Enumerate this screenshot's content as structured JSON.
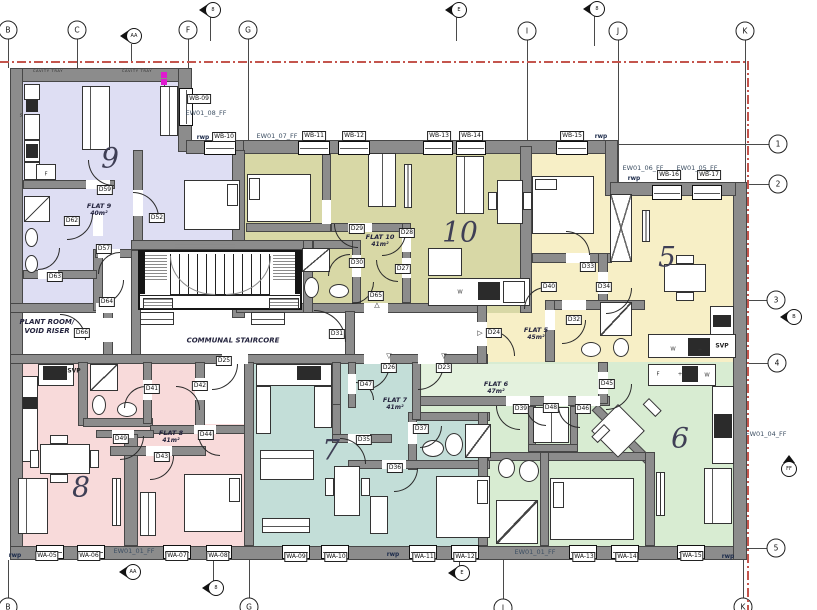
{
  "colors": {
    "wall": "#8c8c8c",
    "flat9": "#dedef3",
    "flat10": "#d8d8a6",
    "flat5": "#f7efc6",
    "flat8": "#f8dada",
    "flat7": "#c3ded8",
    "flat6": "#d8ecd2",
    "flat6_lobby": "#e4f2de",
    "boundary_line": "#c4554d",
    "marker_magenta": "#e019d0"
  },
  "flats": [
    {
      "l1": "FLAT 9",
      "l2": "40m²",
      "x": 99,
      "y": 210
    },
    {
      "l1": "FLAT 10",
      "l2": "41m²",
      "x": 380,
      "y": 241
    },
    {
      "l1": "FLAT 5",
      "l2": "45m²",
      "x": 536,
      "y": 334
    },
    {
      "l1": "FLAT 8",
      "l2": "41m²",
      "x": 171,
      "y": 437
    },
    {
      "l1": "FLAT 7",
      "l2": "41m²",
      "x": 395,
      "y": 404
    },
    {
      "l1": "FLAT 6",
      "l2": "47m²",
      "x": 496,
      "y": 388
    }
  ],
  "big_numbers": [
    {
      "t": "9",
      "x": 110,
      "y": 158
    },
    {
      "t": "10",
      "x": 460,
      "y": 232
    },
    {
      "t": "5",
      "x": 667,
      "y": 257
    },
    {
      "t": "8",
      "x": 81,
      "y": 487
    },
    {
      "t": "7",
      "x": 331,
      "y": 450
    },
    {
      "t": "6",
      "x": 680,
      "y": 438
    }
  ],
  "room_labels": [
    {
      "l1": "PLANT ROOM/",
      "l2": "VOID RISER",
      "x": 47,
      "y": 327
    },
    {
      "l1": "COMMUNAL STAIRCORE",
      "l2": "",
      "x": 233,
      "y": 341
    }
  ],
  "door_tags": [
    {
      "t": "D59",
      "x": 105,
      "y": 190
    },
    {
      "t": "D62",
      "x": 72,
      "y": 221
    },
    {
      "t": "D52",
      "x": 157,
      "y": 218
    },
    {
      "t": "D57",
      "x": 104,
      "y": 249
    },
    {
      "t": "D63",
      "x": 55,
      "y": 277
    },
    {
      "t": "D64",
      "x": 107,
      "y": 302
    },
    {
      "t": "D66",
      "x": 82,
      "y": 333
    },
    {
      "t": "D31",
      "x": 337,
      "y": 334
    },
    {
      "t": "D25",
      "x": 224,
      "y": 361
    },
    {
      "t": "D29",
      "x": 357,
      "y": 229
    },
    {
      "t": "D28",
      "x": 407,
      "y": 233
    },
    {
      "t": "D30",
      "x": 357,
      "y": 263
    },
    {
      "t": "D27",
      "x": 403,
      "y": 269
    },
    {
      "t": "D65",
      "x": 376,
      "y": 296
    },
    {
      "t": "D24",
      "x": 494,
      "y": 333
    },
    {
      "t": "D33",
      "x": 588,
      "y": 267
    },
    {
      "t": "D40",
      "x": 549,
      "y": 287
    },
    {
      "t": "D34",
      "x": 604,
      "y": 287
    },
    {
      "t": "D32",
      "x": 574,
      "y": 320
    },
    {
      "t": "D41",
      "x": 152,
      "y": 389
    },
    {
      "t": "D42",
      "x": 200,
      "y": 386
    },
    {
      "t": "D44",
      "x": 206,
      "y": 435
    },
    {
      "t": "D49",
      "x": 121,
      "y": 439
    },
    {
      "t": "D43",
      "x": 162,
      "y": 457
    },
    {
      "t": "D26",
      "x": 389,
      "y": 368
    },
    {
      "t": "D23",
      "x": 444,
      "y": 368
    },
    {
      "t": "D47",
      "x": 366,
      "y": 385
    },
    {
      "t": "D35",
      "x": 364,
      "y": 440
    },
    {
      "t": "D36",
      "x": 395,
      "y": 468
    },
    {
      "t": "D37",
      "x": 421,
      "y": 429
    },
    {
      "t": "D45",
      "x": 607,
      "y": 384
    },
    {
      "t": "D39",
      "x": 521,
      "y": 409
    },
    {
      "t": "D48",
      "x": 551,
      "y": 408
    },
    {
      "t": "D46",
      "x": 583,
      "y": 409
    }
  ],
  "window_tags": [
    {
      "t": "WB-09",
      "x": 199,
      "y": 99
    },
    {
      "t": "WB-10",
      "x": 224,
      "y": 137
    },
    {
      "t": "WB-11",
      "x": 314,
      "y": 136
    },
    {
      "t": "WB-12",
      "x": 354,
      "y": 136
    },
    {
      "t": "WB-13",
      "x": 439,
      "y": 136
    },
    {
      "t": "WB-14",
      "x": 471,
      "y": 136
    },
    {
      "t": "WB-15",
      "x": 572,
      "y": 136
    },
    {
      "t": "WB-16",
      "x": 669,
      "y": 175
    },
    {
      "t": "WB-17",
      "x": 709,
      "y": 175
    },
    {
      "t": "WA-05",
      "x": 47,
      "y": 556
    },
    {
      "t": "WA-06",
      "x": 89,
      "y": 556
    },
    {
      "t": "WA-07",
      "x": 177,
      "y": 556
    },
    {
      "t": "WA-08",
      "x": 218,
      "y": 556
    },
    {
      "t": "WA-09",
      "x": 296,
      "y": 557
    },
    {
      "t": "WA-10",
      "x": 336,
      "y": 557
    },
    {
      "t": "WA-11",
      "x": 424,
      "y": 557
    },
    {
      "t": "WA-12",
      "x": 465,
      "y": 557
    },
    {
      "t": "WA-13",
      "x": 584,
      "y": 557
    },
    {
      "t": "WA-14",
      "x": 627,
      "y": 557
    },
    {
      "t": "WA-15",
      "x": 692,
      "y": 556
    }
  ],
  "texts": [
    {
      "t": "EW01_08_FF",
      "x": 206,
      "y": 113,
      "cls": "ew"
    },
    {
      "t": "EW01_07_FF",
      "x": 277,
      "y": 136,
      "cls": "ew"
    },
    {
      "t": "EW01_06_FF",
      "x": 643,
      "y": 168,
      "cls": "ew"
    },
    {
      "t": "EW01_05_FF",
      "x": 697,
      "y": 168,
      "cls": "ew"
    },
    {
      "t": "EW01_01_FF",
      "x": 134,
      "y": 551,
      "cls": "ew"
    },
    {
      "t": "EW01_01_FF",
      "x": 535,
      "y": 552,
      "cls": "ew"
    },
    {
      "t": "EW01_04_FF",
      "x": 766,
      "y": 434,
      "cls": "ew"
    },
    {
      "t": "rwp",
      "x": 203,
      "y": 137,
      "cls": "rwp"
    },
    {
      "t": "rwp",
      "x": 601,
      "y": 136,
      "cls": "rwp"
    },
    {
      "t": "rwp",
      "x": 634,
      "y": 178,
      "cls": "rwp"
    },
    {
      "t": "rwp",
      "x": 15,
      "y": 555,
      "cls": "rwp"
    },
    {
      "t": "rwp",
      "x": 393,
      "y": 554,
      "cls": "rwp"
    },
    {
      "t": "rwp",
      "x": 728,
      "y": 556,
      "cls": "rwp"
    },
    {
      "t": "SVP",
      "x": 74,
      "y": 371,
      "cls": "svp"
    },
    {
      "t": "SVP",
      "x": 722,
      "y": 346,
      "cls": "svp"
    },
    {
      "t": "CAVITY TRAY",
      "x": 48,
      "y": 71,
      "cls": "cavity"
    },
    {
      "t": "CAVITY TRAY",
      "x": 137,
      "y": 71,
      "cls": "cavity"
    },
    {
      "t": "W",
      "x": 460,
      "y": 292,
      "cls": "let"
    },
    {
      "t": "W",
      "x": 673,
      "y": 349,
      "cls": "let"
    },
    {
      "t": "+",
      "x": 700,
      "y": 350,
      "cls": "let"
    },
    {
      "t": "F",
      "x": 658,
      "y": 374,
      "cls": "let"
    },
    {
      "t": "+",
      "x": 680,
      "y": 374,
      "cls": "let"
    },
    {
      "t": "W",
      "x": 707,
      "y": 375,
      "cls": "let"
    },
    {
      "t": "F",
      "x": 46,
      "y": 174,
      "cls": "let"
    },
    {
      "t": "s",
      "x": 21,
      "y": 115,
      "cls": "let"
    },
    {
      "t": "△",
      "x": 377,
      "y": 305,
      "cls": "trig"
    },
    {
      "t": "▽",
      "x": 389,
      "y": 356,
      "cls": "trig"
    },
    {
      "t": "▽",
      "x": 444,
      "y": 356,
      "cls": "trig"
    },
    {
      "t": "▷",
      "x": 480,
      "y": 333,
      "cls": "trig"
    }
  ],
  "grid_bubbles": [
    {
      "t": "B",
      "x": 8,
      "y": 30
    },
    {
      "t": "C",
      "x": 77,
      "y": 30
    },
    {
      "t": "F",
      "x": 188,
      "y": 30
    },
    {
      "t": "G",
      "x": 248,
      "y": 30
    },
    {
      "t": "I",
      "x": 527,
      "y": 31
    },
    {
      "t": "J",
      "x": 618,
      "y": 31
    },
    {
      "t": "K",
      "x": 745,
      "y": 31
    },
    {
      "t": "1",
      "x": 778,
      "y": 144
    },
    {
      "t": "2",
      "x": 778,
      "y": 184
    },
    {
      "t": "3",
      "x": 776,
      "y": 300
    },
    {
      "t": "4",
      "x": 777,
      "y": 363
    },
    {
      "t": "5",
      "x": 776,
      "y": 548
    },
    {
      "t": "B",
      "x": 8,
      "y": 607
    },
    {
      "t": "G",
      "x": 249,
      "y": 607
    },
    {
      "t": "I",
      "x": 503,
      "y": 608
    },
    {
      "t": "K",
      "x": 743,
      "y": 607
    }
  ],
  "markers": [
    {
      "t": "AA",
      "x": 131,
      "y": 36,
      "type": "m-left"
    },
    {
      "t": "8",
      "x": 210,
      "y": 10,
      "type": "m-ball"
    },
    {
      "t": "E",
      "x": 456,
      "y": 10,
      "type": "m-ball"
    },
    {
      "t": "8",
      "x": 594,
      "y": 9,
      "type": "m-ball"
    },
    {
      "t": "AA",
      "x": 130,
      "y": 572,
      "type": "m-left"
    },
    {
      "t": "8",
      "x": 213,
      "y": 588,
      "type": "m-ball"
    },
    {
      "t": "E",
      "x": 459,
      "y": 573,
      "type": "m-left"
    },
    {
      "t": "B",
      "x": 791,
      "y": 317,
      "type": "m-left"
    },
    {
      "t": "FF",
      "x": 789,
      "y": 466,
      "type": "m-up"
    }
  ]
}
